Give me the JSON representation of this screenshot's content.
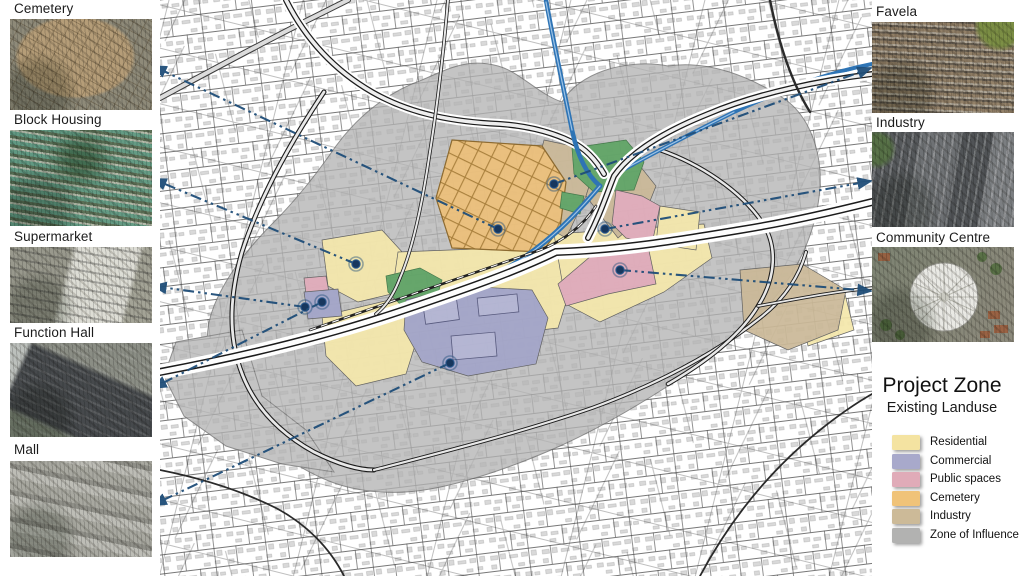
{
  "left_panel": {
    "items": [
      {
        "label": "Cemetery"
      },
      {
        "label": "Block Housing"
      },
      {
        "label": "Supermarket"
      },
      {
        "label": "Function Hall"
      },
      {
        "label": "Mall"
      }
    ]
  },
  "right_panel": {
    "items": [
      {
        "label": "Favela"
      },
      {
        "label": "Industry"
      },
      {
        "label": "Community Centre"
      }
    ]
  },
  "legend": {
    "title": "Project Zone",
    "subtitle": "Existing Landuse",
    "entries": [
      {
        "label": "Residential",
        "color": "#F4E3A1"
      },
      {
        "label": "Commercial",
        "color": "#A8A9CB"
      },
      {
        "label": "Public spaces",
        "color": "#E0ABB8"
      },
      {
        "label": "Cemetery",
        "color": "#F0C379"
      },
      {
        "label": "Industry",
        "color": "#CCBA98"
      },
      {
        "label": "Zone of Influence",
        "color": "#B2B2B1"
      }
    ]
  },
  "map": {
    "colors": {
      "residential": "#F5E8AC",
      "commercial": "#A3A5C9",
      "public": "#E2ACBB",
      "cemetery": "#EDC07A",
      "industry": "#CBB998",
      "influence": "#b4b4b4",
      "green": "#5FA465",
      "river": "#2E74B5",
      "leader": "#1F4E79"
    },
    "leaders": [
      {
        "name": "cemetery",
        "from": [
          153,
          66
        ],
        "to": [
          498,
          229
        ]
      },
      {
        "name": "block-housing",
        "from": [
          153,
          179
        ],
        "to": [
          356,
          264
        ]
      },
      {
        "name": "supermarket",
        "from": [
          153,
          286
        ],
        "to": [
          305,
          307
        ]
      },
      {
        "name": "function-hall",
        "from": [
          153,
          388
        ],
        "to": [
          322,
          302
        ]
      },
      {
        "name": "mall",
        "from": [
          153,
          505
        ],
        "to": [
          450,
          363
        ]
      },
      {
        "name": "favela",
        "from": [
          871,
          68
        ],
        "to": [
          554,
          184
        ]
      },
      {
        "name": "industry",
        "from": [
          871,
          181
        ],
        "to": [
          605,
          229
        ]
      },
      {
        "name": "community-centre",
        "from": [
          871,
          291
        ],
        "to": [
          620,
          270
        ]
      }
    ]
  }
}
